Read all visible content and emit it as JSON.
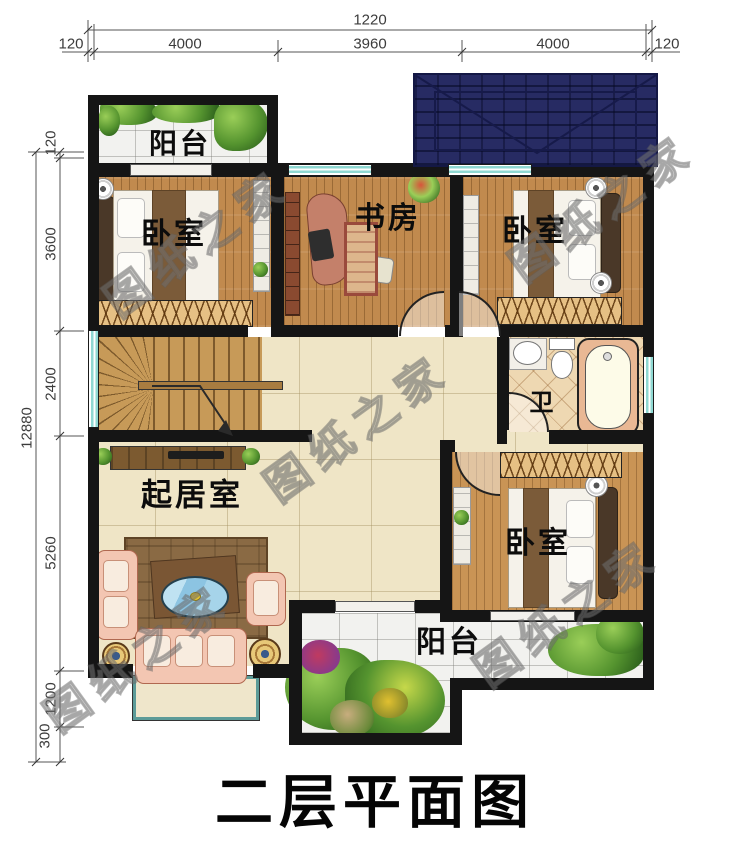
{
  "title": "二层平面图",
  "watermark": "图纸之家",
  "rooms": {
    "balcony_top": "阳台",
    "bedroom_top_left": "卧室",
    "study": "书房",
    "bedroom_top_right": "卧室",
    "bath": "卫",
    "living_room": "起居室",
    "bedroom_bottom_right": "卧室",
    "balcony_bottom": "阳台"
  },
  "dimensions": {
    "top": {
      "total": "1220",
      "segments": [
        "120",
        "4000",
        "3960",
        "4000",
        "120"
      ]
    },
    "left": {
      "total": "12880",
      "segments": [
        "120",
        "3600",
        "2400",
        "5260",
        "1200",
        "300"
      ]
    }
  },
  "colors": {
    "wall": "#151515",
    "roof": "#272b63",
    "window": "#8fd8d2",
    "wood_floor": "#c18a4e",
    "tile_floor": "#efe5c6",
    "balcony_tile": "#f2f2ef"
  }
}
